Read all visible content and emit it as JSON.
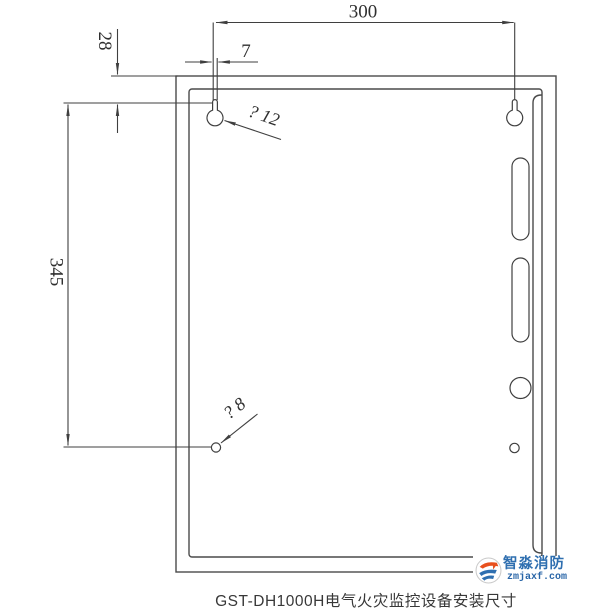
{
  "drawing": {
    "caption": "GST-DH1000H电气火灾监控设备安装尺寸",
    "dimensions": {
      "top_width": "300",
      "top_edge_to_hole": "28",
      "keyhole_slot_width": "7",
      "hole_vertical_spacing": "345",
      "top_hole_label": "? 12",
      "bottom_hole_label": "? 8"
    }
  },
  "watermark": {
    "brand": "智淼消防",
    "site": "zmjaxf.com",
    "icon": "zhimiao-swoosh-logo-icon"
  },
  "colors": {
    "line": "#3f3f3f",
    "box_line": "#4a4a4a",
    "dimension_text": "#2f2f2f",
    "caption_text": "#383838",
    "brand_blue": "#2f6fb0",
    "site_blue": "#2a66a8",
    "accent_orange": "#e8501e",
    "background": "#ffffff"
  }
}
